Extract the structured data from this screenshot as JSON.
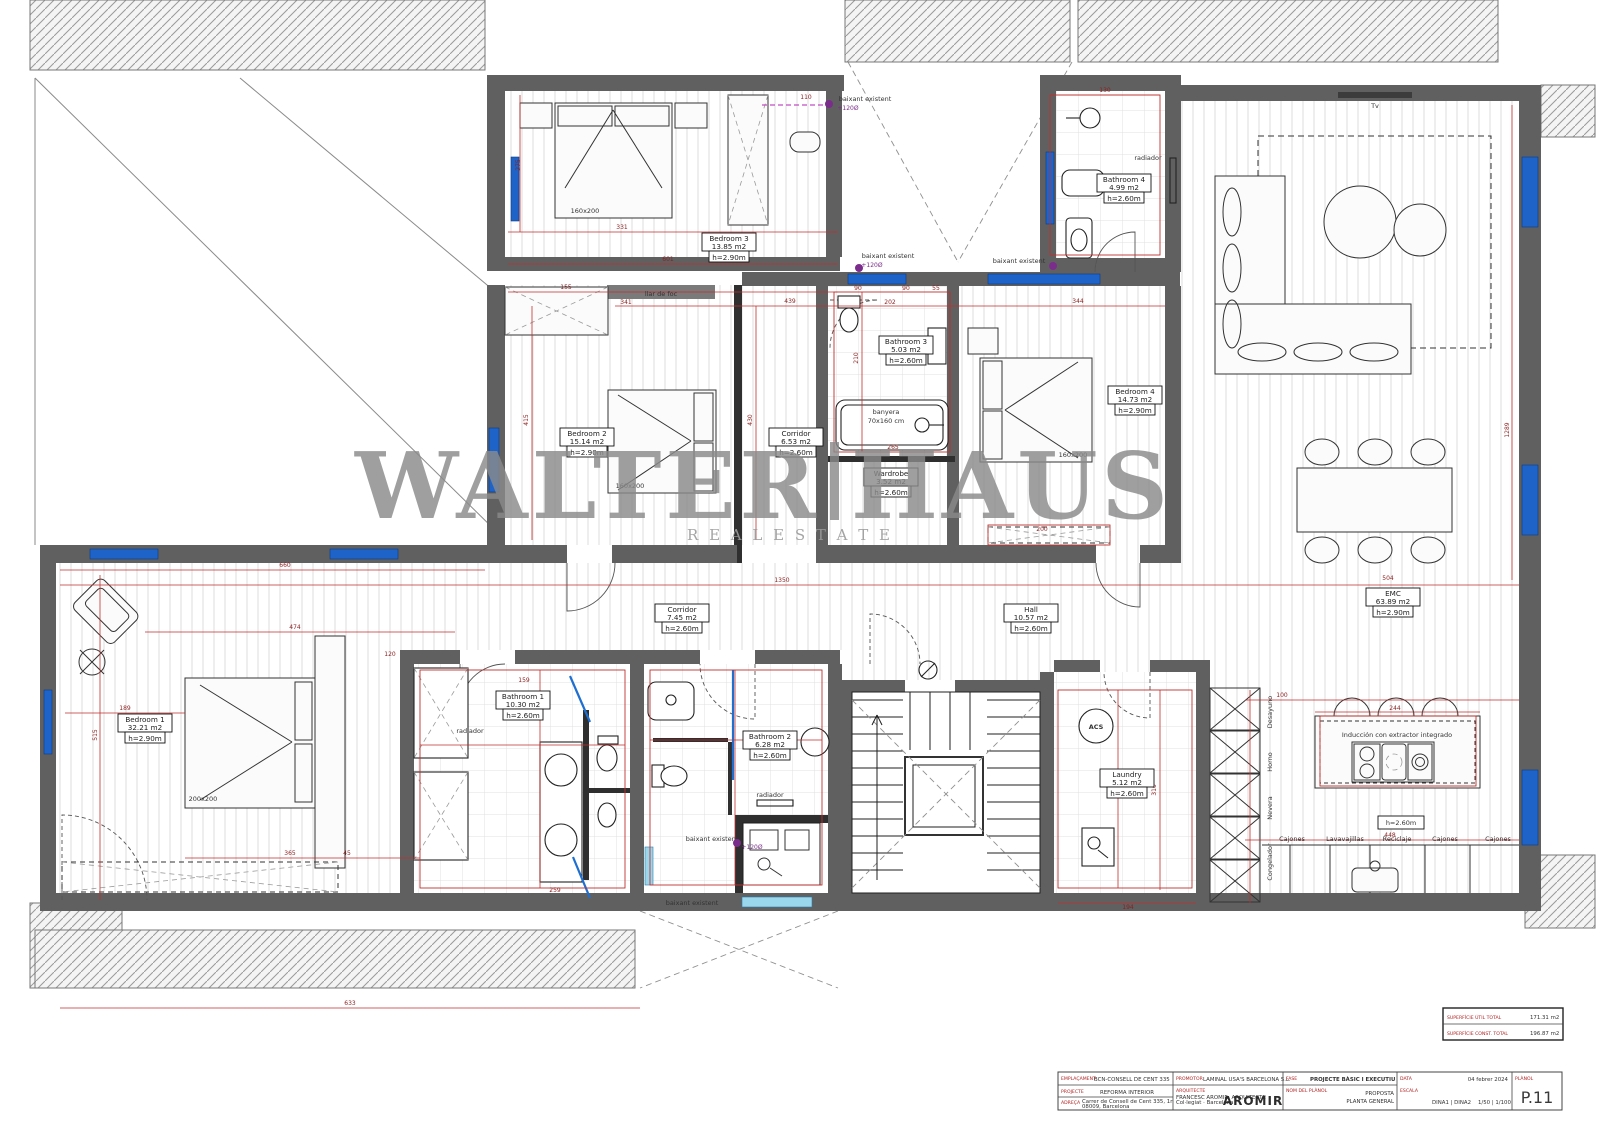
{
  "watermark": {
    "word1": "WALTER",
    "word2": "HAUS",
    "subtitle": "R E A L   E S T A T E"
  },
  "rooms": {
    "bedroom3": {
      "name": "Bedroom 3",
      "area": "13.85 m2",
      "height": "h=2.90m"
    },
    "bathroom4": {
      "name": "Bathroom 4",
      "area": "4.99 m2",
      "height": "h=2.60m"
    },
    "bedroom2": {
      "name": "Bedroom 2",
      "area": "15.14 m2",
      "height": "h=2.90m"
    },
    "corridor1": {
      "name": "Corridor",
      "area": "6.53 m2",
      "height": "h=2.60m"
    },
    "bathroom3": {
      "name": "Bathroom 3",
      "area": "5.03 m2",
      "height": "h=2.60m"
    },
    "wardrobe": {
      "name": "Wardrobe",
      "area": "3.52 m2",
      "height": "h=2.60m"
    },
    "bedroom4": {
      "name": "Bedroom 4",
      "area": "14.73 m2",
      "height": "h=2.90m"
    },
    "corridor2": {
      "name": "Corridor",
      "area": "7.45 m2",
      "height": "h=2.60m"
    },
    "hall": {
      "name": "Hall",
      "area": "10.57 m2",
      "height": "h=2.60m"
    },
    "bedroom1": {
      "name": "Bedroom 1",
      "area": "32.21 m2",
      "height": "h=2.90m"
    },
    "bathroom1": {
      "name": "Bathroom 1",
      "area": "10.30 m2",
      "height": "h=2.60m"
    },
    "bathroom2": {
      "name": "Bathroom 2",
      "area": "6.28 m2",
      "height": "h=2.60m"
    },
    "laundry": {
      "name": "Laundry",
      "area": "5.12 m2",
      "height": "h=2.60m"
    },
    "emc": {
      "name": "EMC",
      "area": "63.89 m2",
      "height": "h=2.90m"
    }
  },
  "annotations": {
    "tv": "Tv",
    "llar_de_foc": "llar de foc",
    "banyera": "banyera",
    "banyera_size": "70x160 cm",
    "radiador": "radiador",
    "baixant": "baixant existent",
    "drain": "+120Ø",
    "acs": "ACS",
    "bed160": "160x200",
    "bed200": "200x200",
    "induction": "Inducción con extractor integrado",
    "kitchen_h": "h=2.60m",
    "congelador": "Congelador",
    "nevera": "Nevera",
    "horno": "Horno",
    "desayuno": "Desayuno",
    "cajones": "Cajones",
    "lavavajillas": "Lavavajillas",
    "reciclaje": "Reciclaje"
  },
  "dims": [
    "331",
    "110",
    "601",
    "275",
    "155",
    "341",
    "439",
    "415",
    "430",
    "90",
    "90",
    "55",
    "202",
    "210",
    "265",
    "344",
    "200",
    "1350",
    "660",
    "474",
    "189",
    "365",
    "45",
    "515",
    "120",
    "159",
    "259",
    "316",
    "194",
    "244",
    "100",
    "448",
    "504",
    "1289",
    "130",
    "633"
  ],
  "titleblock": {
    "site_label": "EMPLAÇAMENT",
    "site": "BCN-CONSELL DE CENT 335",
    "work_label": "PROJECTE",
    "work": "REFORMA INTERIOR",
    "address_label": "ADREÇA",
    "address1": "Carrer de Consell de Cent 335, 1r",
    "address2": "08009, Barcelona",
    "promoter_label": "PROMOTOR",
    "promoter": "LAMINAL USA'S BARCELONA S.L.",
    "architect_label": "ARQUITECTE",
    "architect1": "FRANCESC AROMIR, ARQUITECTE",
    "architect2": "Col·legiat · Barcelona",
    "logo": "AROMIR",
    "phase_label": "FASE",
    "phase": "PROJECTE BÀSIC I EXECUTIU",
    "plan_label": "NOM DEL PLÀNOL",
    "plan1": "PROPOSTA",
    "plan2": "PLANTA GENERAL",
    "date_label": "DATA",
    "date": "04 febrer 2024",
    "scale_label": "ESCALA",
    "formats": "DINA1 | DINA2",
    "scales": "1/50 | 1/100",
    "number_label": "PLÀNOL",
    "number": "P.11",
    "area_util_label": "SUPERFÍCIE ÚTIL TOTAL",
    "area_util": "171.31 m2",
    "area_const_label": "SUPERFÍCIE CONST. TOTAL",
    "area_const": "196.87 m2"
  }
}
